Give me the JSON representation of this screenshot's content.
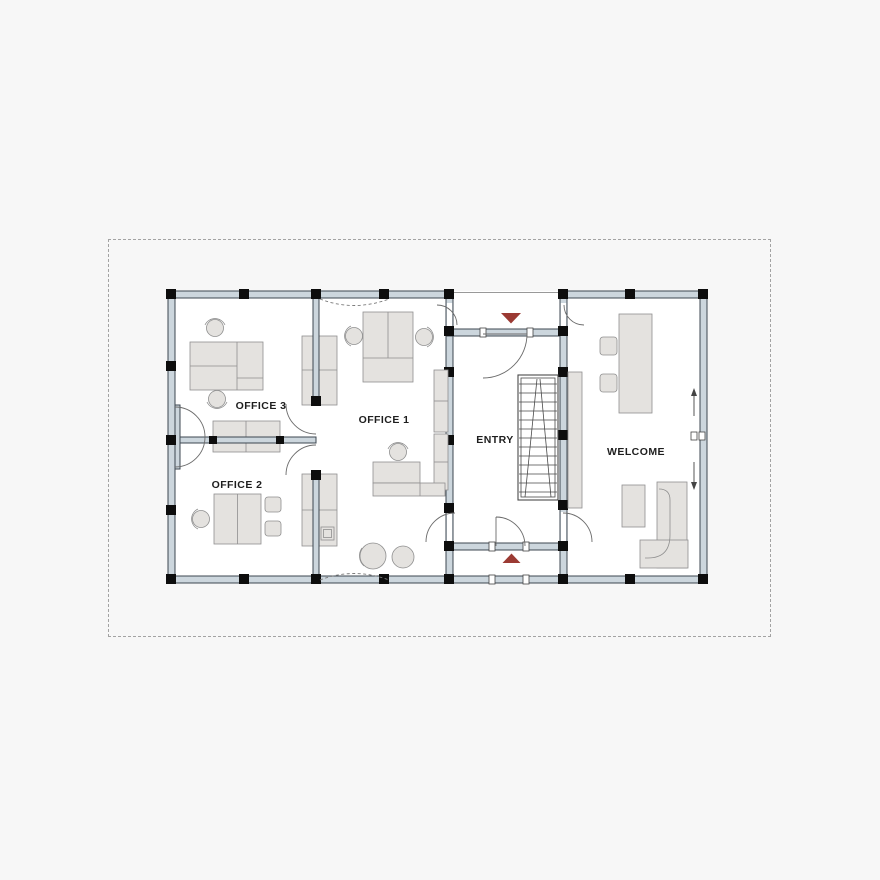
{
  "plan": {
    "rooms": [
      {
        "id": "office-3",
        "label": "OFFICE 3"
      },
      {
        "id": "office-2",
        "label": "OFFICE 2"
      },
      {
        "id": "office-1",
        "label": "OFFICE 1"
      },
      {
        "id": "entry",
        "label": "ENTRY"
      },
      {
        "id": "welcome",
        "label": "WELCOME"
      }
    ],
    "markers": [
      {
        "id": "entry-marker-top",
        "shape": "triangle-down"
      },
      {
        "id": "entry-marker-bottom",
        "shape": "triangle-up"
      }
    ],
    "colors": {
      "background": "#f7f7f7",
      "floor": "#ffffff",
      "wall_fill": "#ccd6dd",
      "wall_line": "#3d4750",
      "column": "#0d0d0d",
      "furniture_fill": "#e4e2df",
      "furniture_line": "#8f8f8f",
      "door_line": "#6b6b6b",
      "stair_line": "#4a4a4a",
      "entry_marker": "#9b3a33",
      "boundary": "#a3a3a3",
      "label_text": "#1e1e1e"
    }
  }
}
